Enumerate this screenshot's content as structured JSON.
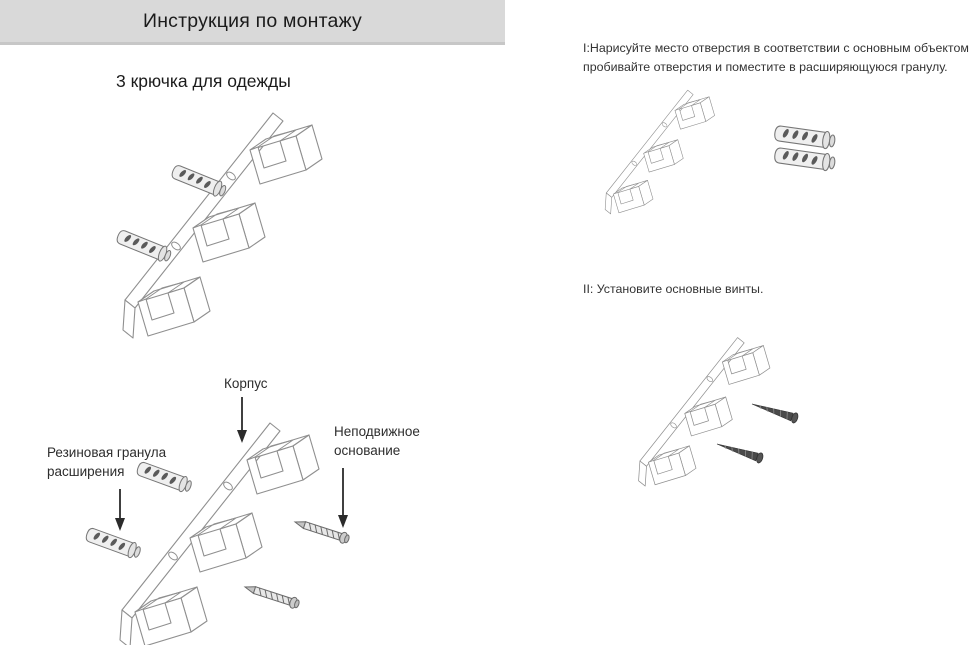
{
  "header": {
    "title": "Инструкция по монтажу"
  },
  "product": {
    "subtitle": "3 крючка для одежды"
  },
  "steps": [
    {
      "number": "I",
      "lines": [
        "I:Нарисуйте место отверстия в соответствии с основным объектом,",
        "пробивайте отверстия и поместите в расширяющуюся гранулу."
      ]
    },
    {
      "number": "II",
      "lines": [
        "II: Установите основные винты."
      ]
    }
  ],
  "diagram_labels": {
    "body": "Корпус",
    "expansion_granule_lines": [
      "Резиновая гранула",
      "расширения"
    ],
    "fixed_base_lines": [
      "Неподвижное",
      "основание"
    ]
  },
  "colors": {
    "header_bg": "#d9d9d9",
    "line_art": "#8f8f8f",
    "text": "#2f2f2f",
    "dark_metal": "#4a4a4a"
  }
}
